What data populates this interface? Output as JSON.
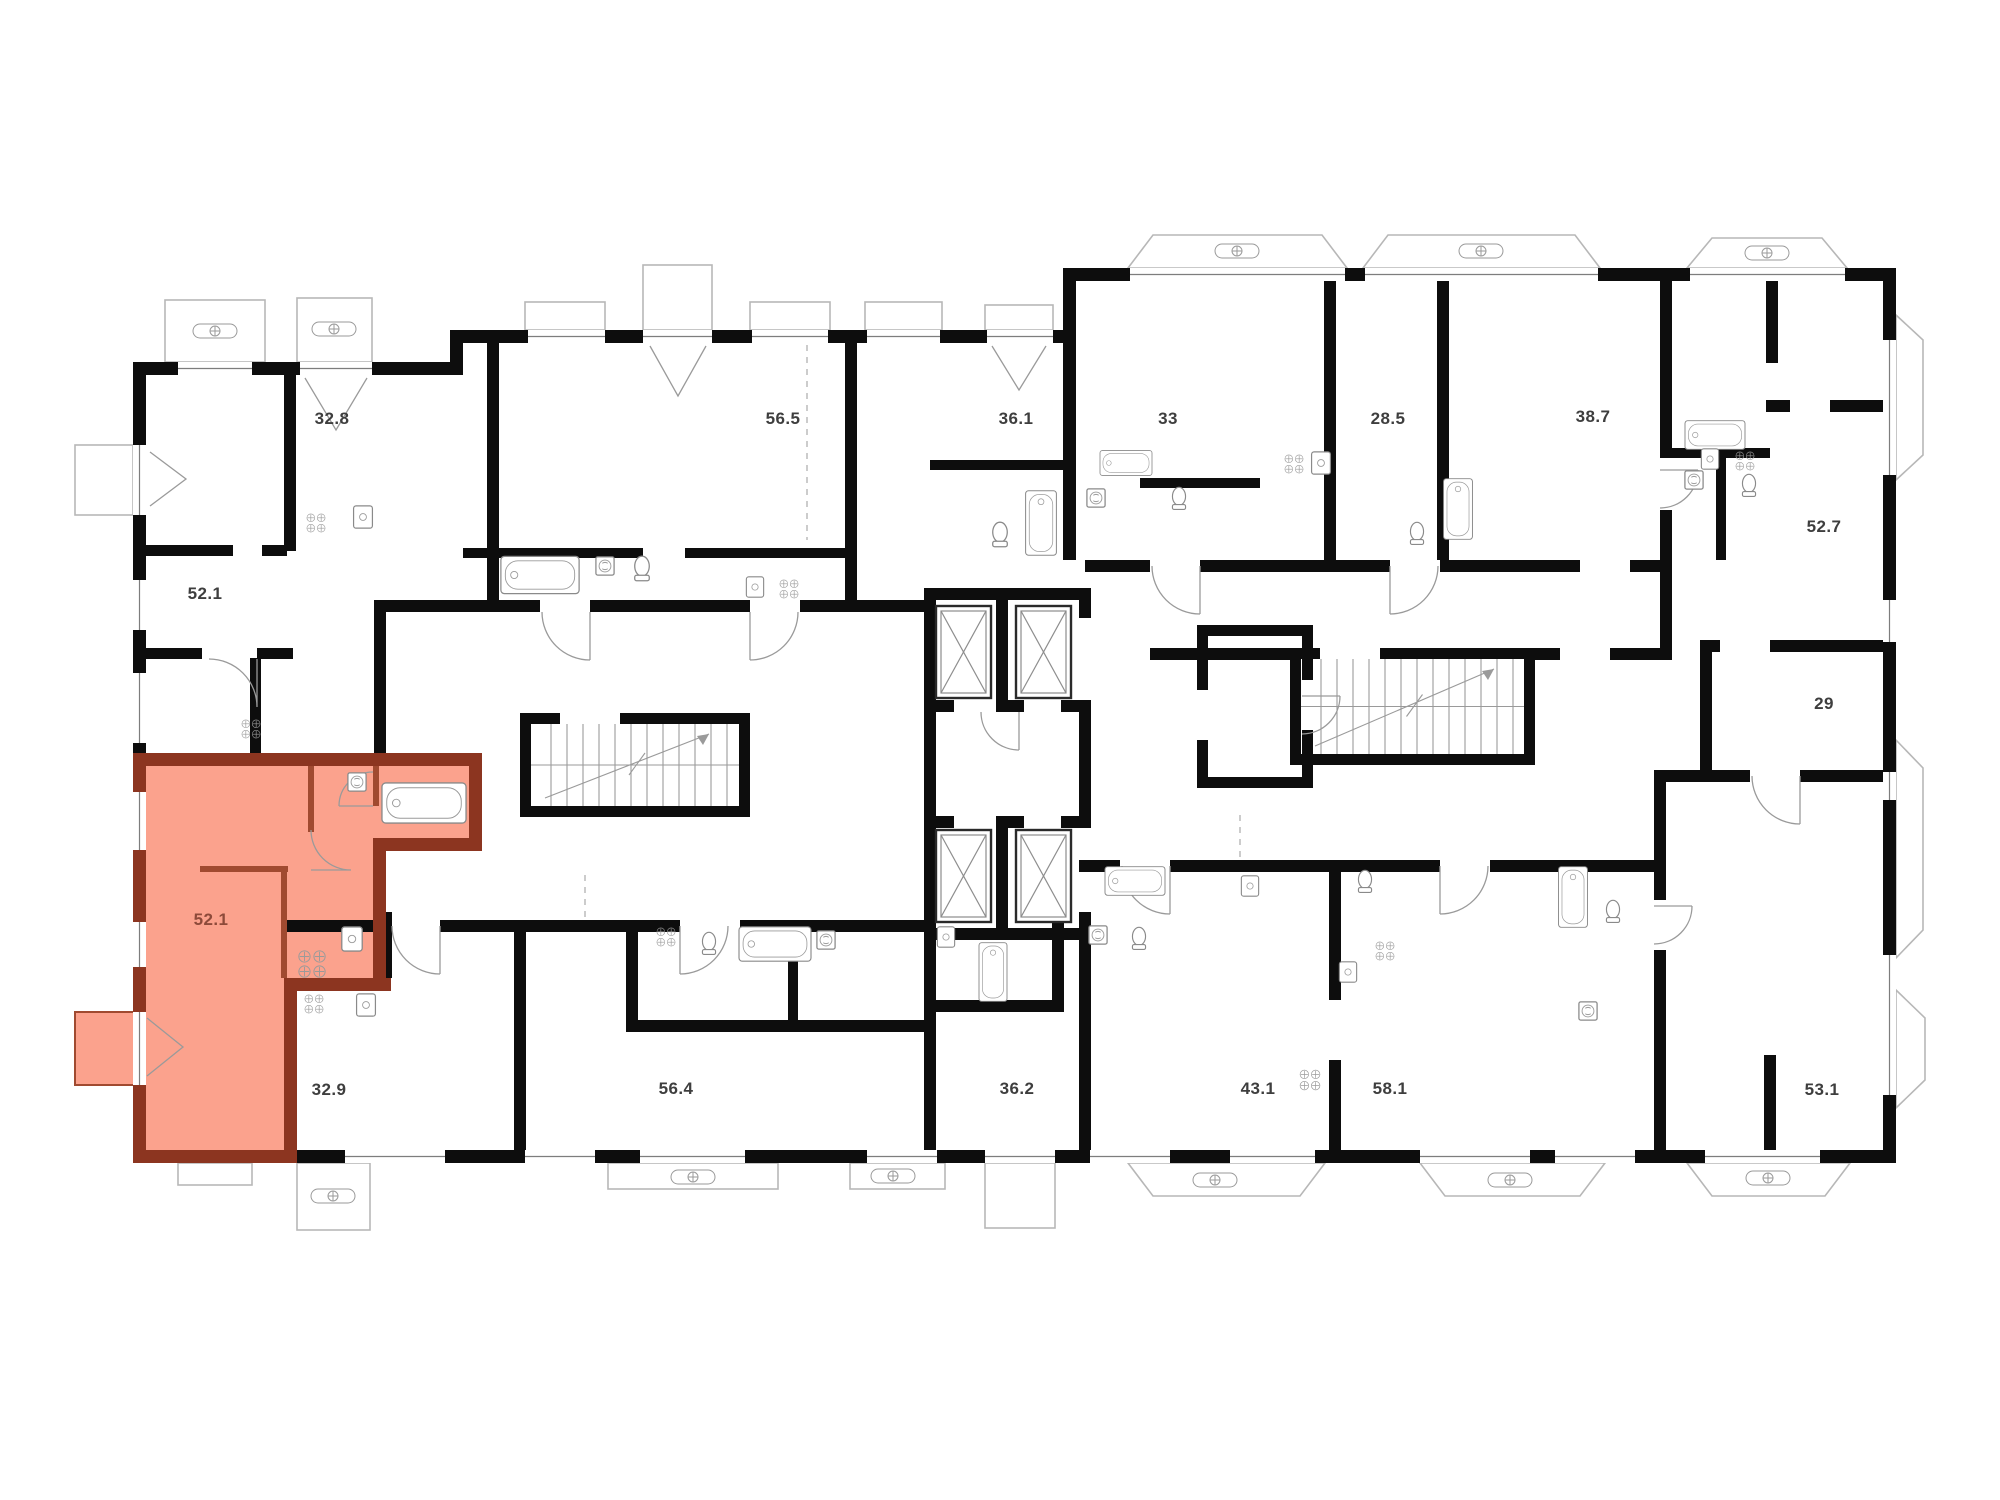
{
  "plan": {
    "kind": "residential-floor-plan",
    "highlighted_unit_area": "52.1"
  },
  "colors": {
    "wall": "#0d0d0d",
    "highlight_fill": "#fba28d",
    "highlight_wall": "#8c3520",
    "highlight_wall_thin": "#a04a30",
    "highlight_label": "#8d4a3a",
    "label": "#3e3e3e",
    "balcony_line": "#b7b7b7"
  },
  "units": [
    {
      "id": "unit-32-8",
      "area": "32.8",
      "highlighted": false
    },
    {
      "id": "unit-56-5",
      "area": "56.5",
      "highlighted": false
    },
    {
      "id": "unit-36-1",
      "area": "36.1",
      "highlighted": false
    },
    {
      "id": "unit-33",
      "area": "33",
      "highlighted": false
    },
    {
      "id": "unit-28-5",
      "area": "28.5",
      "highlighted": false
    },
    {
      "id": "unit-38-7",
      "area": "38.7",
      "highlighted": false
    },
    {
      "id": "unit-52-7",
      "area": "52.7",
      "highlighted": false
    },
    {
      "id": "unit-52-1",
      "area": "52.1",
      "highlighted": false
    },
    {
      "id": "unit-29",
      "area": "29",
      "highlighted": false
    },
    {
      "id": "unit-52-1-selected",
      "area": "52.1",
      "highlighted": true
    },
    {
      "id": "unit-32-9",
      "area": "32.9",
      "highlighted": false
    },
    {
      "id": "unit-56-4",
      "area": "56.4",
      "highlighted": false
    },
    {
      "id": "unit-36-2",
      "area": "36.2",
      "highlighted": false
    },
    {
      "id": "unit-43-1",
      "area": "43.1",
      "highlighted": false
    },
    {
      "id": "unit-58-1",
      "area": "58.1",
      "highlighted": false
    },
    {
      "id": "unit-53-1",
      "area": "53.1",
      "highlighted": false
    }
  ]
}
